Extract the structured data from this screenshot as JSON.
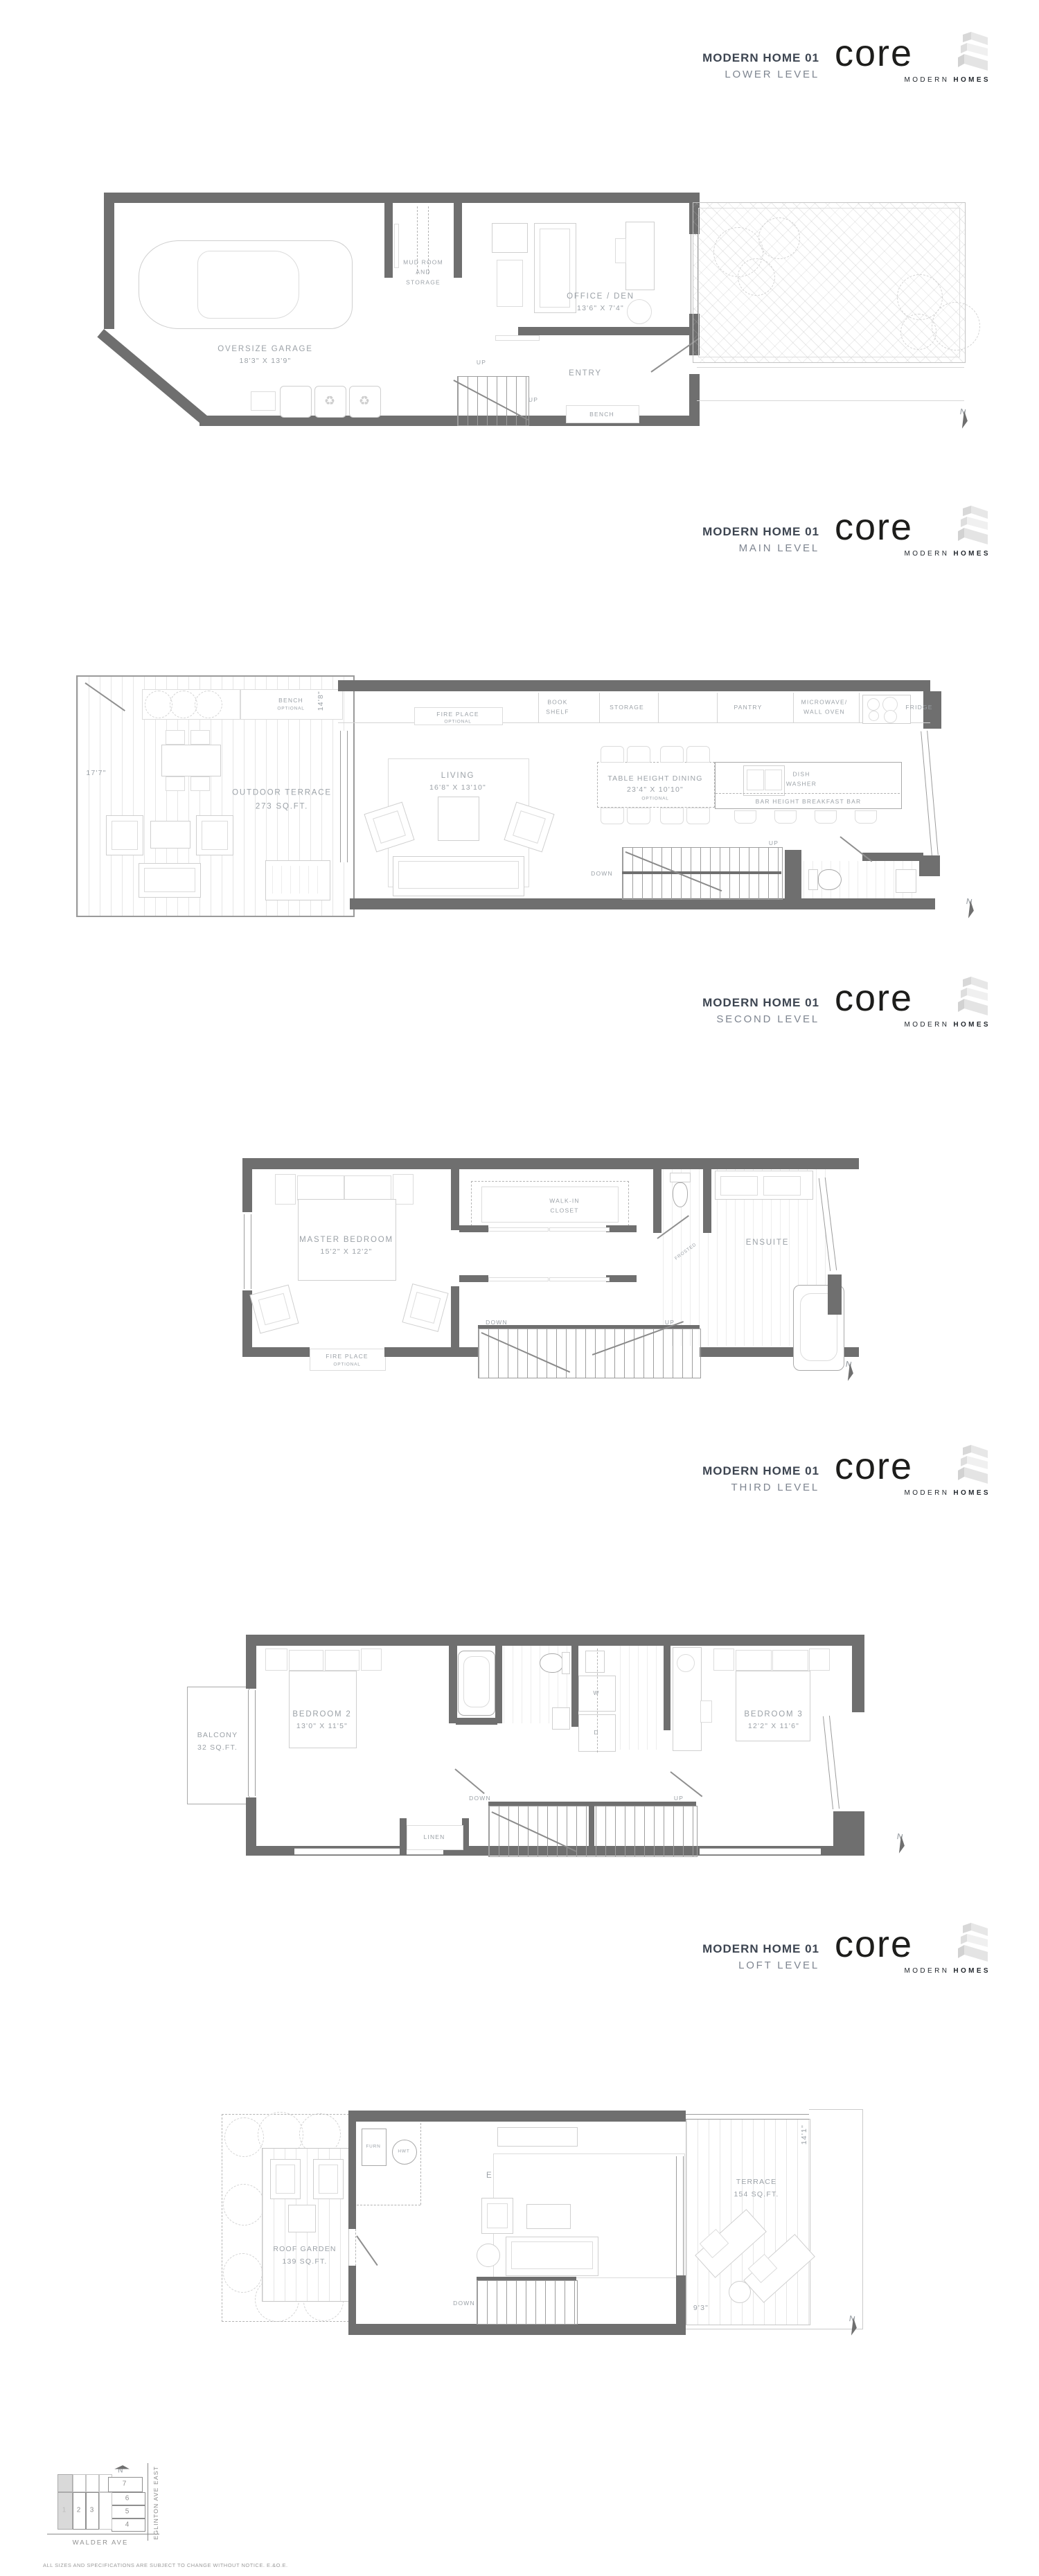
{
  "brand": {
    "logo_text": "core",
    "logo_sub_1": "MODERN",
    "logo_sub_2": "HOMES"
  },
  "levels": [
    {
      "title": "MODERN HOME 01",
      "subtitle": "LOWER LEVEL"
    },
    {
      "title": "MODERN HOME 01",
      "subtitle": "MAIN LEVEL"
    },
    {
      "title": "MODERN HOME 01",
      "subtitle": "SECOND LEVEL"
    },
    {
      "title": "MODERN HOME 01",
      "subtitle": "THIRD LEVEL"
    },
    {
      "title": "MODERN HOME 01",
      "subtitle": "LOFT LEVEL"
    }
  ],
  "lower": {
    "garage_name": "OVERSIZE GARAGE",
    "garage_dim": "18'3\" X 13'9\"",
    "mudroom": "MUD ROOM\nAND\nSTORAGE",
    "office_name": "OFFICE / DEN",
    "office_dim": "13'6\" X 7'4\"",
    "entry": "ENTRY",
    "bench": "BENCH",
    "up_a": "UP",
    "up_b": "UP"
  },
  "main": {
    "terrace": "OUTDOOR TERRACE\n273 SQ.FT.",
    "bench": "BENCH",
    "bench_opt": "OPTIONAL",
    "dim_width": "17'7\"",
    "dim_depth": "14'8\"",
    "fireplace": "FIRE PLACE",
    "fireplace_opt": "OPTIONAL",
    "bookshelf": "BOOK\nSHELF",
    "storage": "STORAGE",
    "pantry": "PANTRY",
    "microwave": "MICROWAVE/\nWALL OVEN",
    "fridge": "FRIDGE",
    "living_name": "LIVING",
    "living_dim": "16'8\" X 13'10\"",
    "dining_name": "TABLE HEIGHT DINING",
    "dining_dim": "23'4\" X 10'10\"",
    "dining_opt": "OPTIONAL",
    "dishwasher": "DISH\nWASHER",
    "breakfast_bar": "BAR HEIGHT BREAKFAST BAR",
    "down": "DOWN",
    "up": "UP"
  },
  "second": {
    "master_name": "MASTER BEDROOM",
    "master_dim": "15'2\" X 12'2\"",
    "walkin": "WALK-IN\nCLOSET",
    "ensuite": "ENSUITE",
    "frosted": "FROSTED",
    "fireplace": "FIRE PLACE",
    "fireplace_opt": "OPTIONAL",
    "down": "DOWN",
    "up": "UP"
  },
  "third": {
    "balcony": "BALCONY\n32 SQ.FT.",
    "bed2_name": "BEDROOM 2",
    "bed2_dim": "13'0\" X 11'5\"",
    "bed3_name": "BEDROOM 3",
    "bed3_dim": "12'2\" X 11'6\"",
    "linen": "LINEN",
    "washer": "W",
    "dryer": "D",
    "down": "DOWN",
    "up": "UP"
  },
  "loft": {
    "roof_garden": "ROOF GARDEN\n139 SQ.FT.",
    "furn": "FURN",
    "hwt": "HWT",
    "ent_name": "ENTERTAINMENT SPACE",
    "ent_dim": "21'0\" X 10'10\"",
    "terrace": "TERRACE\n154 SQ.FT.",
    "dim_depth": "14'1\"",
    "dim_width": "9'3\"",
    "down": "DOWN"
  },
  "site": {
    "lots": [
      "1",
      "2",
      "3",
      "4",
      "5",
      "6",
      "7"
    ],
    "street_bottom": "WALDER AVE",
    "street_right": "EGLINTON AVE EAST"
  },
  "compass": {
    "label": "N"
  },
  "icons": {
    "recycle": "♻"
  },
  "disclaimer": "ALL SIZES AND SPECIFICATIONS ARE SUBJECT TO CHANGE WITHOUT NOTICE. E.&O.E."
}
